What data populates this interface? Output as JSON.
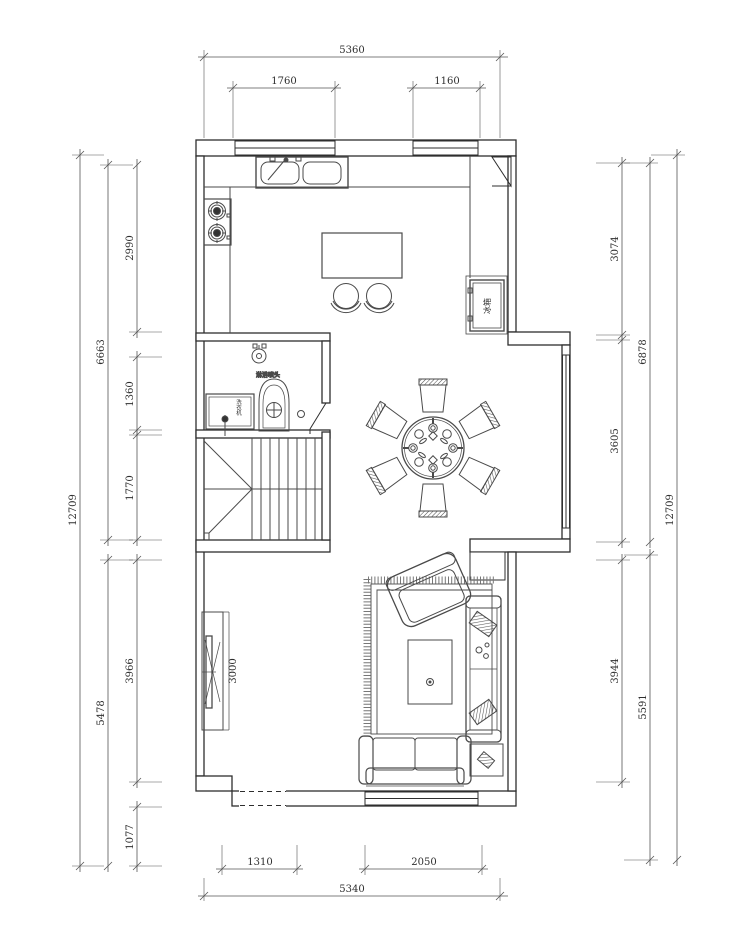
{
  "drawing": {
    "kind": "residential floor plan (CAD)",
    "units": "mm",
    "dimensions": {
      "top": {
        "overall": "5360",
        "window_left": "1760",
        "window_right": "1160"
      },
      "bottom": {
        "opening": "1310",
        "window": "2050",
        "overall": "5340"
      },
      "left": {
        "overall": "12709",
        "upper_total": "6663",
        "lower_total": "5478",
        "kitchen": "2990",
        "bath": "1360",
        "stairs": "1770",
        "living": "3966",
        "porch": "1077"
      },
      "right": {
        "overall": "12709",
        "upper_total": "6878",
        "lower_total": "5591",
        "kitchen": "3074",
        "dining": "3605",
        "living": "3944"
      }
    },
    "labels": {
      "fridge": "冰箱",
      "washing_machine": "洗衣机",
      "shower": "淋浴喷头",
      "tv_length": "3000"
    },
    "colors": {
      "line": "#2e2e2e",
      "furniture": "#4a4a4a",
      "dimension": "#555555"
    }
  }
}
